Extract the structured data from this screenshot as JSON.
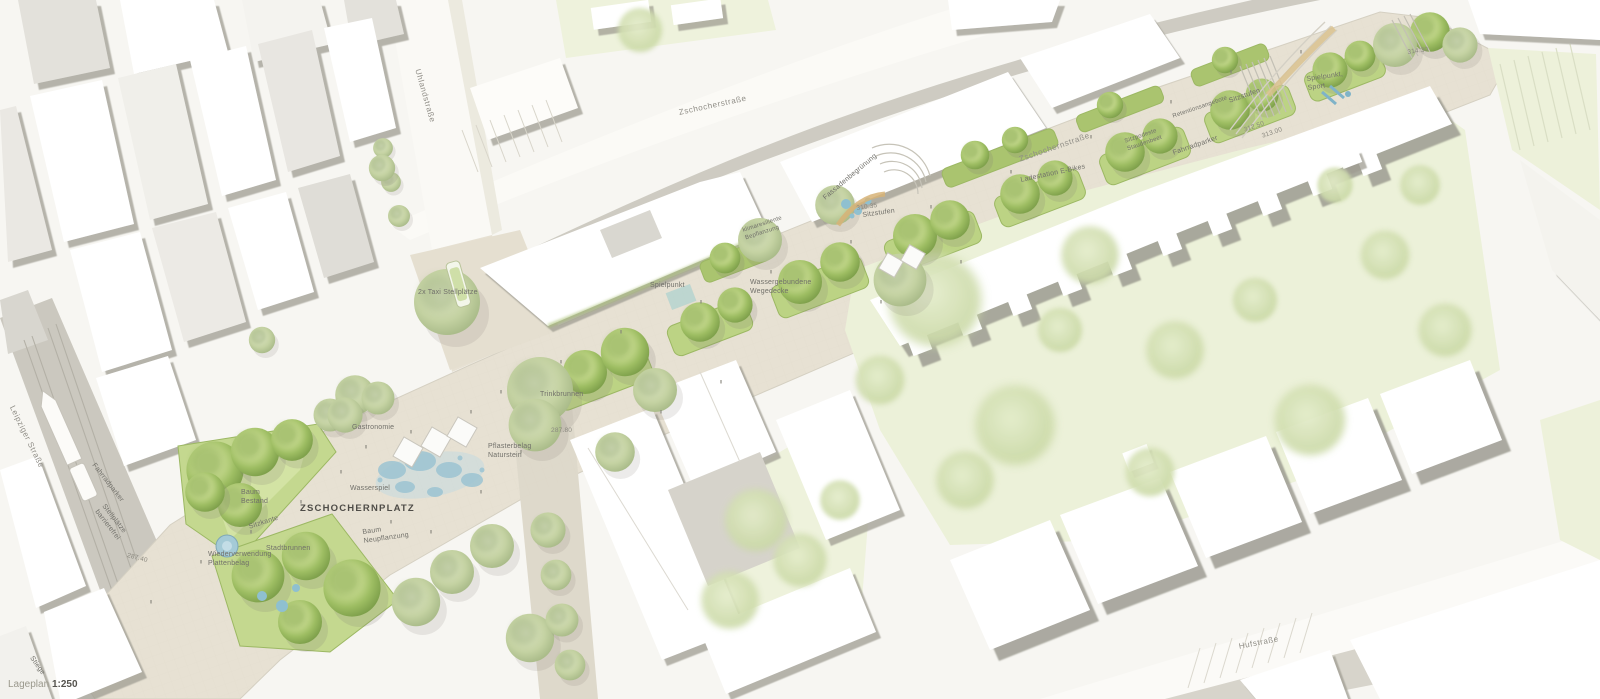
{
  "plan": {
    "title": "ZSCHOCHERNPLATZ",
    "caption": {
      "label": "Lageplan",
      "scale": "1:250"
    },
    "streets": [
      {
        "name": "Leipziger Straße"
      },
      {
        "name": "Uhlandstraße"
      },
      {
        "name": "Zschocherstraße"
      },
      {
        "name": "Zschochernstraße"
      },
      {
        "name": "Hufstraße"
      }
    ],
    "annotations": [
      {
        "text": "2x Taxi Stellplätze"
      },
      {
        "text": "Gastronomie"
      },
      {
        "text": "Wasserspiel"
      },
      {
        "text": "Baum\nBestand"
      },
      {
        "text": "Sitzkante"
      },
      {
        "text": "Stadtbrunnen"
      },
      {
        "text": "Wiederverwendung\nPlattenbelag"
      },
      {
        "text": "Fahrradparker"
      },
      {
        "text": "Stellplätze\nbarrierefrei"
      },
      {
        "text": "Baum\nNeupflanzung"
      },
      {
        "text": "Pflasterbelag\nNaturstein"
      },
      {
        "text": "Trinkbrunnen"
      },
      {
        "text": "Spielpunkt"
      },
      {
        "text": "Wassergebundene\nWegedecke"
      },
      {
        "text": "klimaresiliente\nBepflanzung"
      },
      {
        "text": "Fassadenbegrünung"
      },
      {
        "text": "Sitzstufen"
      },
      {
        "text": "Ladestation E-Bikes"
      },
      {
        "text": "Sitzpodeste\nStaudenbeet"
      },
      {
        "text": "Fahrradparker"
      },
      {
        "text": "Retentionsangebote"
      },
      {
        "text": "Sitzstufen"
      },
      {
        "text": "Spielpunkt,\nSport"
      },
      {
        "text": "Stiege"
      }
    ],
    "elevations": [
      "287.40",
      "287.80",
      "310.35",
      "312.50",
      "313.00",
      "314.30"
    ],
    "colors": {
      "pavement": "#e7e1d3",
      "street_gray": "#cbc8bf",
      "lawn": "#c4d88f",
      "tree_green": "#9dbd62",
      "park_green": "#ecf1d9",
      "building_white": "#ffffff",
      "shadow_gray": "#9f9d93",
      "water_blue": "#9cc3d2",
      "label_gray": "#71706a"
    }
  }
}
